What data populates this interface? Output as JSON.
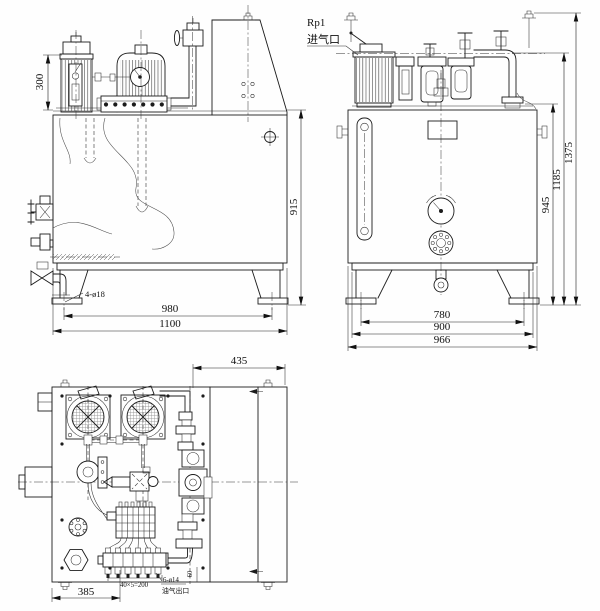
{
  "drawing": {
    "front_view": {
      "dim_motor_height": "300",
      "dim_tank_height": "915",
      "foot_holes_label": "4-ø18",
      "dim_foot_pitch": "980",
      "dim_overall_width": "1100"
    },
    "side_view": {
      "air_inlet_thread": "Rp1",
      "air_inlet_label": "进气口",
      "dim_pipe_height": "945",
      "dim_valve_height": "1185",
      "dim_overall_height": "1375",
      "dim_foot_pitch": "780",
      "dim_base_width": "900",
      "dim_tank_width": "966"
    },
    "plan_view": {
      "dim_panel_width": "435",
      "dim_outlet_offset": "385",
      "dim_outlet_pitch": "40×5=200",
      "outlet_holes_label": "6-ø14",
      "outlet_port_label": "油气出口",
      "dim_edge_offset": "60"
    }
  }
}
